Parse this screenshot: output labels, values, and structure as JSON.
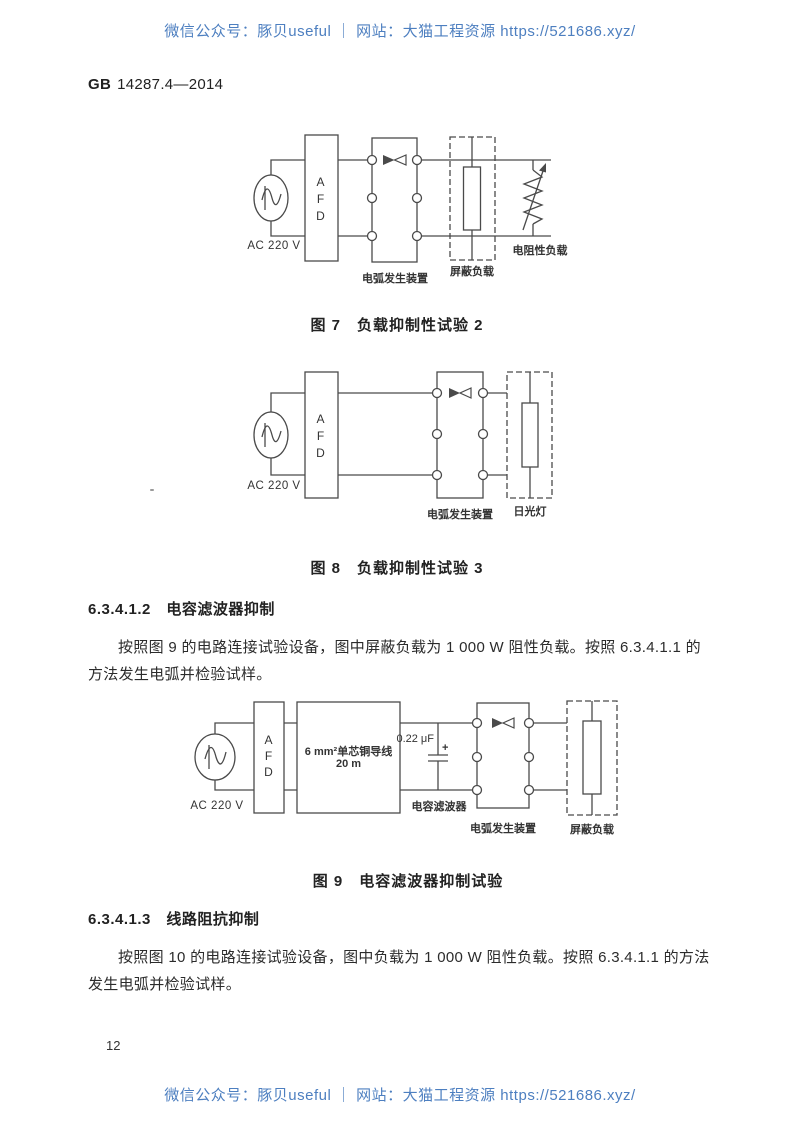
{
  "watermark": {
    "text": "微信公众号：豚贝useful ｜ 网站：大猫工程资源 https://521686.xyz/",
    "color": "#4d7fc0"
  },
  "header": {
    "standard_prefix": "GB",
    "standard_number": "14287.4—2014"
  },
  "figures": {
    "fig7": {
      "source_label": "AC 220 V",
      "afd": [
        "A",
        "F",
        "D"
      ],
      "arc_device_label": "电弧发生装置",
      "shield_load_label": "屏蔽负载",
      "resistive_load_label": "电阻性负载",
      "caption": "图 7　负载抑制性试验 2"
    },
    "fig8": {
      "source_label": "AC 220 V",
      "afd": [
        "A",
        "F",
        "D"
      ],
      "arc_device_label": "电弧发生装置",
      "lamp_label": "日光灯",
      "caption": "图 8　负载抑制性试验 3"
    },
    "fig9": {
      "source_label": "AC 220 V",
      "afd": [
        "A",
        "F",
        "D"
      ],
      "wire_box_line1": "6 mm²单芯铜导线",
      "wire_box_line2": "20 m",
      "capacitor_value": "0.22 μF",
      "capacitor_polarity": "+",
      "filter_label": "电容滤波器",
      "arc_device_label": "电弧发生装置",
      "shield_load_label": "屏蔽负载",
      "caption": "图 9　电容滤波器抑制试验"
    }
  },
  "sections": {
    "s2": {
      "heading": "6.3.4.1.2　电容滤波器抑制",
      "body": "按照图 9 的电路连接试验设备，图中屏蔽负载为 1 000 W 阻性负载。按照 6.3.4.1.1 的方法发生电弧并检验试样。"
    },
    "s3": {
      "heading": "6.3.4.1.3　线路阻抗抑制",
      "body": "按照图 10 的电路连接试验设备，图中负载为 1 000 W 阻性负载。按照 6.3.4.1.1 的方法发生电弧并检验试样。"
    }
  },
  "page_number": "12"
}
